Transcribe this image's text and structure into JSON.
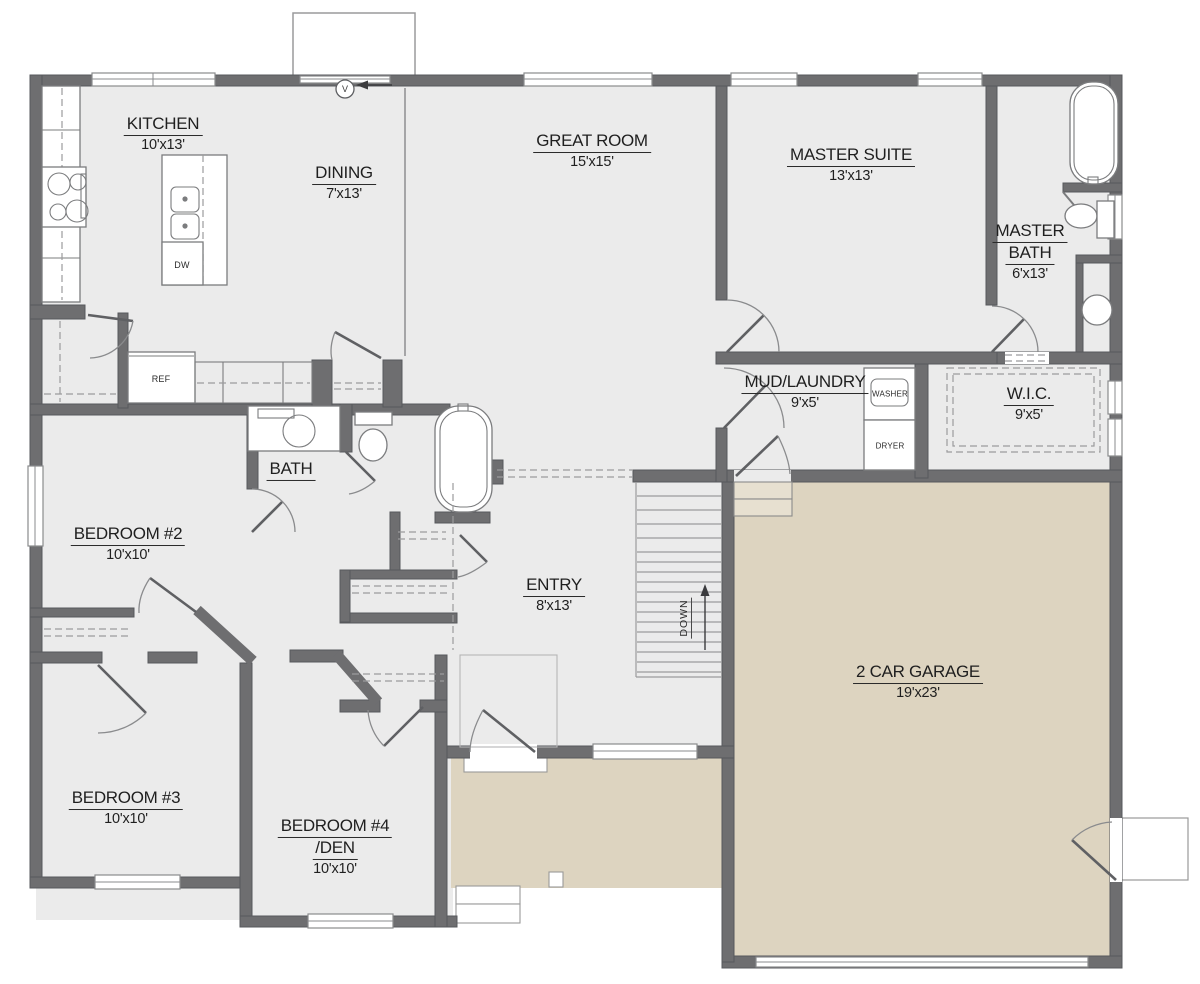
{
  "title": "First floor plan",
  "colors": {
    "wall": "#6e6e70",
    "floor": "#ebebeb",
    "tan": "#ddd4c0",
    "line": "#9b9b9d",
    "text": "#1f1f1f"
  },
  "rooms": [
    {
      "id": "kitchen",
      "name": "KITCHEN",
      "dims": "10'x13'"
    },
    {
      "id": "dining",
      "name": "DINING",
      "dims": "7'x13'"
    },
    {
      "id": "great-room",
      "name": "GREAT ROOM",
      "dims": "15'x15'"
    },
    {
      "id": "master-suite",
      "name": "MASTER SUITE",
      "dims": "13'x13'"
    },
    {
      "id": "master-bath",
      "name": "MASTER",
      "name2": "BATH",
      "dims": "6'x13'"
    },
    {
      "id": "mud-laundry",
      "name": "MUD/LAUNDRY",
      "dims": "9'x5'"
    },
    {
      "id": "wic",
      "name": "W.I.C.",
      "dims": "9'x5'"
    },
    {
      "id": "bath",
      "name": "BATH",
      "dims": ""
    },
    {
      "id": "bedroom-2",
      "name": "BEDROOM #2",
      "dims": "10'x10'"
    },
    {
      "id": "entry",
      "name": "ENTRY",
      "dims": "8'x13'"
    },
    {
      "id": "garage",
      "name": "2 CAR GARAGE",
      "dims": "19'x23'"
    },
    {
      "id": "bedroom-3",
      "name": "BEDROOM #3",
      "dims": "10'x10'"
    },
    {
      "id": "bedroom-4",
      "name": "BEDROOM #4",
      "name2": "/DEN",
      "dims": "10'x10'"
    }
  ],
  "fixtures": {
    "ref": "REF",
    "dw": "DW",
    "washer": "WASHER",
    "dryer": "DRYER",
    "down": "DOWN",
    "vent": "V"
  }
}
